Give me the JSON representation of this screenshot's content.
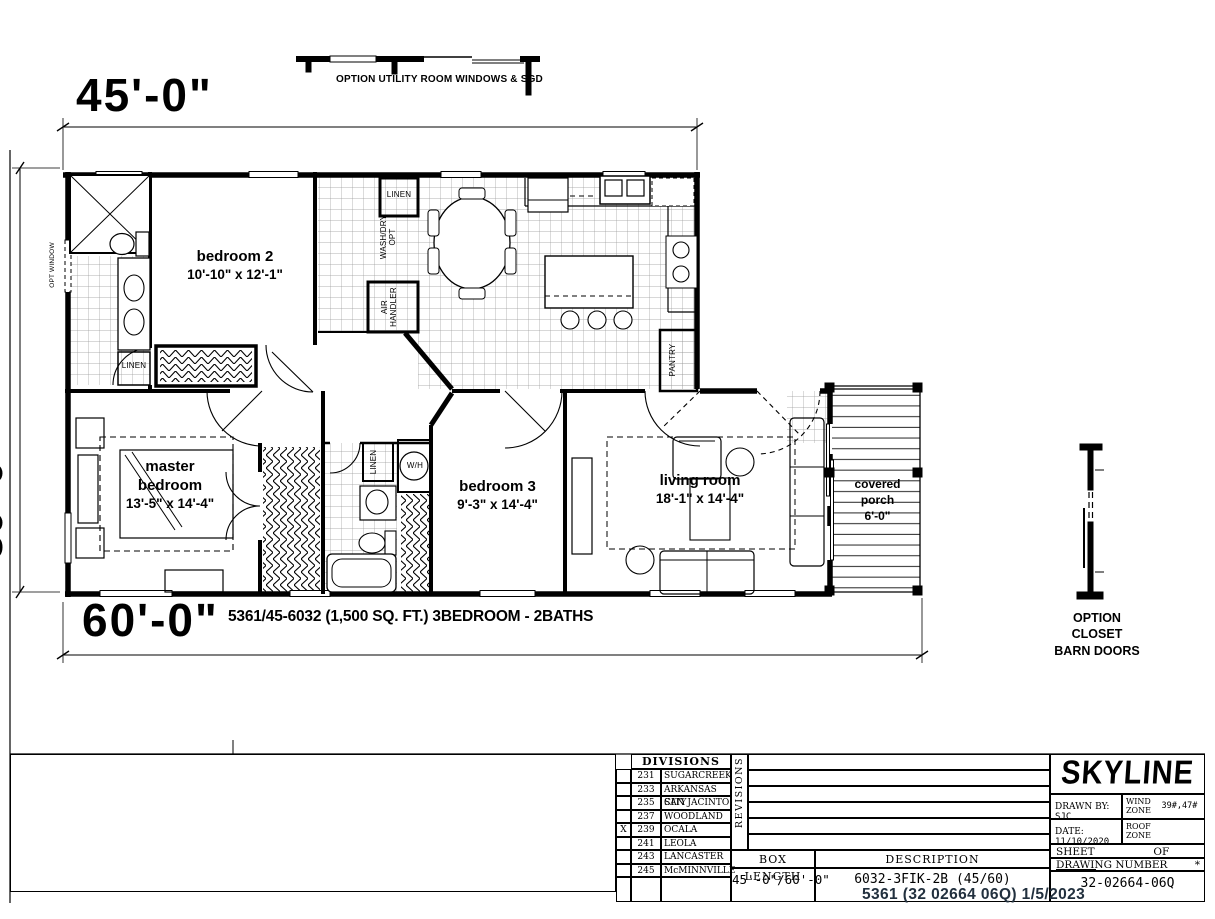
{
  "page": {
    "dim_top": "45'-0\"",
    "dim_bottom": "60'-0\"",
    "dim_left_partial": "30'-0\"",
    "plan_title": "5361/45-6032 (1,500 SQ. FT.) 3BEDROOM - 2BATHS",
    "top_option_note": "OPTION UTILITY ROOM WINDOWS & SGD",
    "side_option_note_lines": [
      "OPTION",
      "CLOSET",
      "BARN DOORS"
    ],
    "stamp": "5361  (32 02664 06Q)  1/5/2023"
  },
  "rooms": {
    "bedroom2": {
      "name": "bedroom 2",
      "size": "10'-10\" x 12'-1\""
    },
    "master": {
      "name1": "master",
      "name2": "bedroom",
      "size": "13'-5\" x 14'-4\""
    },
    "bedroom3": {
      "name": "bedroom 3",
      "size": "9'-3\" x 14'-4\""
    },
    "living": {
      "name": "living room",
      "size": "18'-1\" x 14'-4\""
    },
    "porch": {
      "name1": "covered",
      "name2": "porch",
      "size": "6'-0\""
    }
  },
  "fixtures": {
    "linen_utility": "LINEN",
    "linen_bath2": "LINEN",
    "linen_hallbath": "LINEN",
    "washdry_line1": "WASH/DRY",
    "washdry_line2": "OPT",
    "air_line1": "AIR",
    "air_line2": "HANDLER",
    "pantry": "PANTRY",
    "water_heater": "W/H",
    "opt_window": "OPT WINDOW"
  },
  "title_block": {
    "divisions_header": "DIVISIONS",
    "divisions": [
      {
        "mark": "",
        "code": "231",
        "name": "SUGARCREEK"
      },
      {
        "mark": "",
        "code": "233",
        "name": "ARKANSAS CITY"
      },
      {
        "mark": "",
        "code": "235",
        "name": "SAN JACINTO"
      },
      {
        "mark": "",
        "code": "237",
        "name": "WOODLAND"
      },
      {
        "mark": "X",
        "code": "239",
        "name": "OCALA"
      },
      {
        "mark": "",
        "code": "241",
        "name": "LEOLA"
      },
      {
        "mark": "",
        "code": "243",
        "name": "LANCASTER"
      },
      {
        "mark": "",
        "code": "245",
        "name": "McMINNVILLE"
      }
    ],
    "revisions_label": "REVISIONS",
    "box_length_label": "BOX LENGTH",
    "box_length_value": "45'-0\"/60'-0\"",
    "description_label": "DESCRIPTION",
    "description_value": "6032-3FIK-2B (45/60)",
    "drawing_number_label": "DRAWING NUMBER",
    "drawing_number_star": "*",
    "drawing_number_value": "32-02664-06Q",
    "brand": "SKYLINE",
    "drawn_by_label": "DRAWN BY:",
    "drawn_by_value": "SJC",
    "wind_zone_label1": "WIND",
    "wind_zone_label2": "ZONE",
    "wind_zone_value": "39#,47#",
    "date_label": "DATE:",
    "date_value": "11/10/2020",
    "roof_zone_label1": "ROOF",
    "roof_zone_label2": "ZONE",
    "sheet_label": "SHEET",
    "of_label": "OF"
  }
}
